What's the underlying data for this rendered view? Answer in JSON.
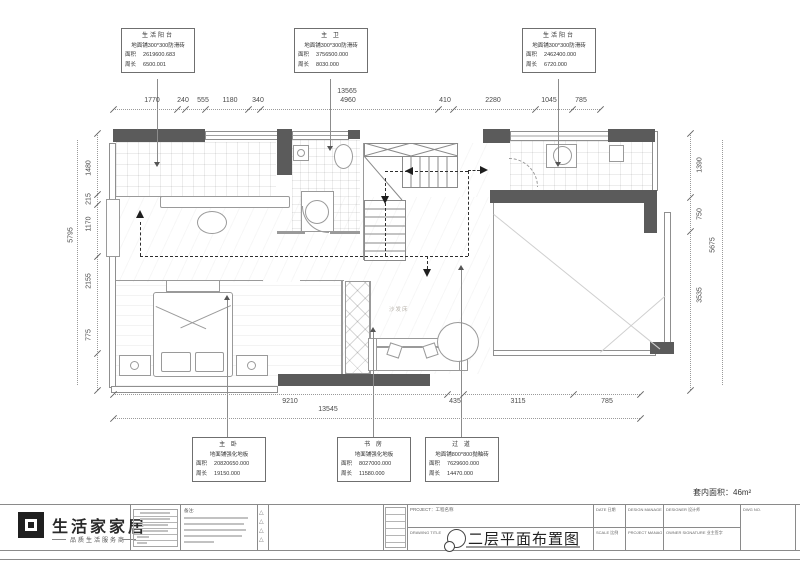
{
  "callouts": {
    "top": [
      {
        "name": "生活阳台",
        "floor": "地面铺300*300防滑砖",
        "area_label": "面积",
        "area": "2619600.683",
        "perim_label": "周长",
        "perim": "6500.001"
      },
      {
        "name": "主 卫",
        "floor": "地面铺300*300防滑砖",
        "area_label": "面积",
        "area": "3756500.000",
        "perim_label": "周长",
        "perim": "8030.000"
      },
      {
        "name": "生活阳台",
        "floor": "地面铺300*300防滑砖",
        "area_label": "面积",
        "area": "2462400.000",
        "perim_label": "周长",
        "perim": "6720.000"
      }
    ],
    "bottom": [
      {
        "name": "主 卧",
        "floor": "地面铺强化地板",
        "area_label": "面积",
        "area": "20820650.000",
        "perim_label": "周长",
        "perim": "19150.000"
      },
      {
        "name": "书 房",
        "floor": "地面铺强化地板",
        "area_label": "面积",
        "area": "8027000.000",
        "perim_label": "周长",
        "perim": "11580.000"
      },
      {
        "name": "过 道",
        "floor": "地面铺800*800抛釉砖",
        "area_label": "面积",
        "area": "7629600.000",
        "perim_label": "周长",
        "perim": "14470.000"
      }
    ]
  },
  "dims": {
    "top": {
      "total": "13565",
      "segs": [
        "1770",
        "240",
        "555",
        "1180",
        "340",
        "4960",
        "410",
        "2280",
        "1045",
        "785"
      ]
    },
    "bottom": {
      "total": "13545",
      "segs": [
        "9210",
        "435",
        "3115",
        "785"
      ]
    },
    "left": {
      "total": "5795",
      "segs": [
        "1480",
        "215",
        "1170",
        "2155",
        "775"
      ]
    },
    "right": {
      "total": "5675",
      "segs": [
        "1390",
        "750",
        "3535"
      ]
    }
  },
  "plan": {
    "sofa_bed_label": "沙发床"
  },
  "title_block": {
    "brand": "生活家家居",
    "tagline": "品质生活服务商",
    "notes_label": "备注:",
    "project_label": "PROJECT：工程名称",
    "drawing_label": "DRAWING TITLE",
    "drawing_title": "二层平面布置图",
    "area_note": "套内面积：46m²",
    "fields": {
      "date": "DATE 日期",
      "scale": "SCALE 比例",
      "design_manager": "DESIGN MANAGER 设计经理",
      "project_manager": "PROJECT MANAGER 项目经理",
      "designer": "DESIGNER 设计师",
      "owner_signature": "OWNER SIGNATURE 业主签字",
      "dwg_no": "DWG NO."
    }
  }
}
